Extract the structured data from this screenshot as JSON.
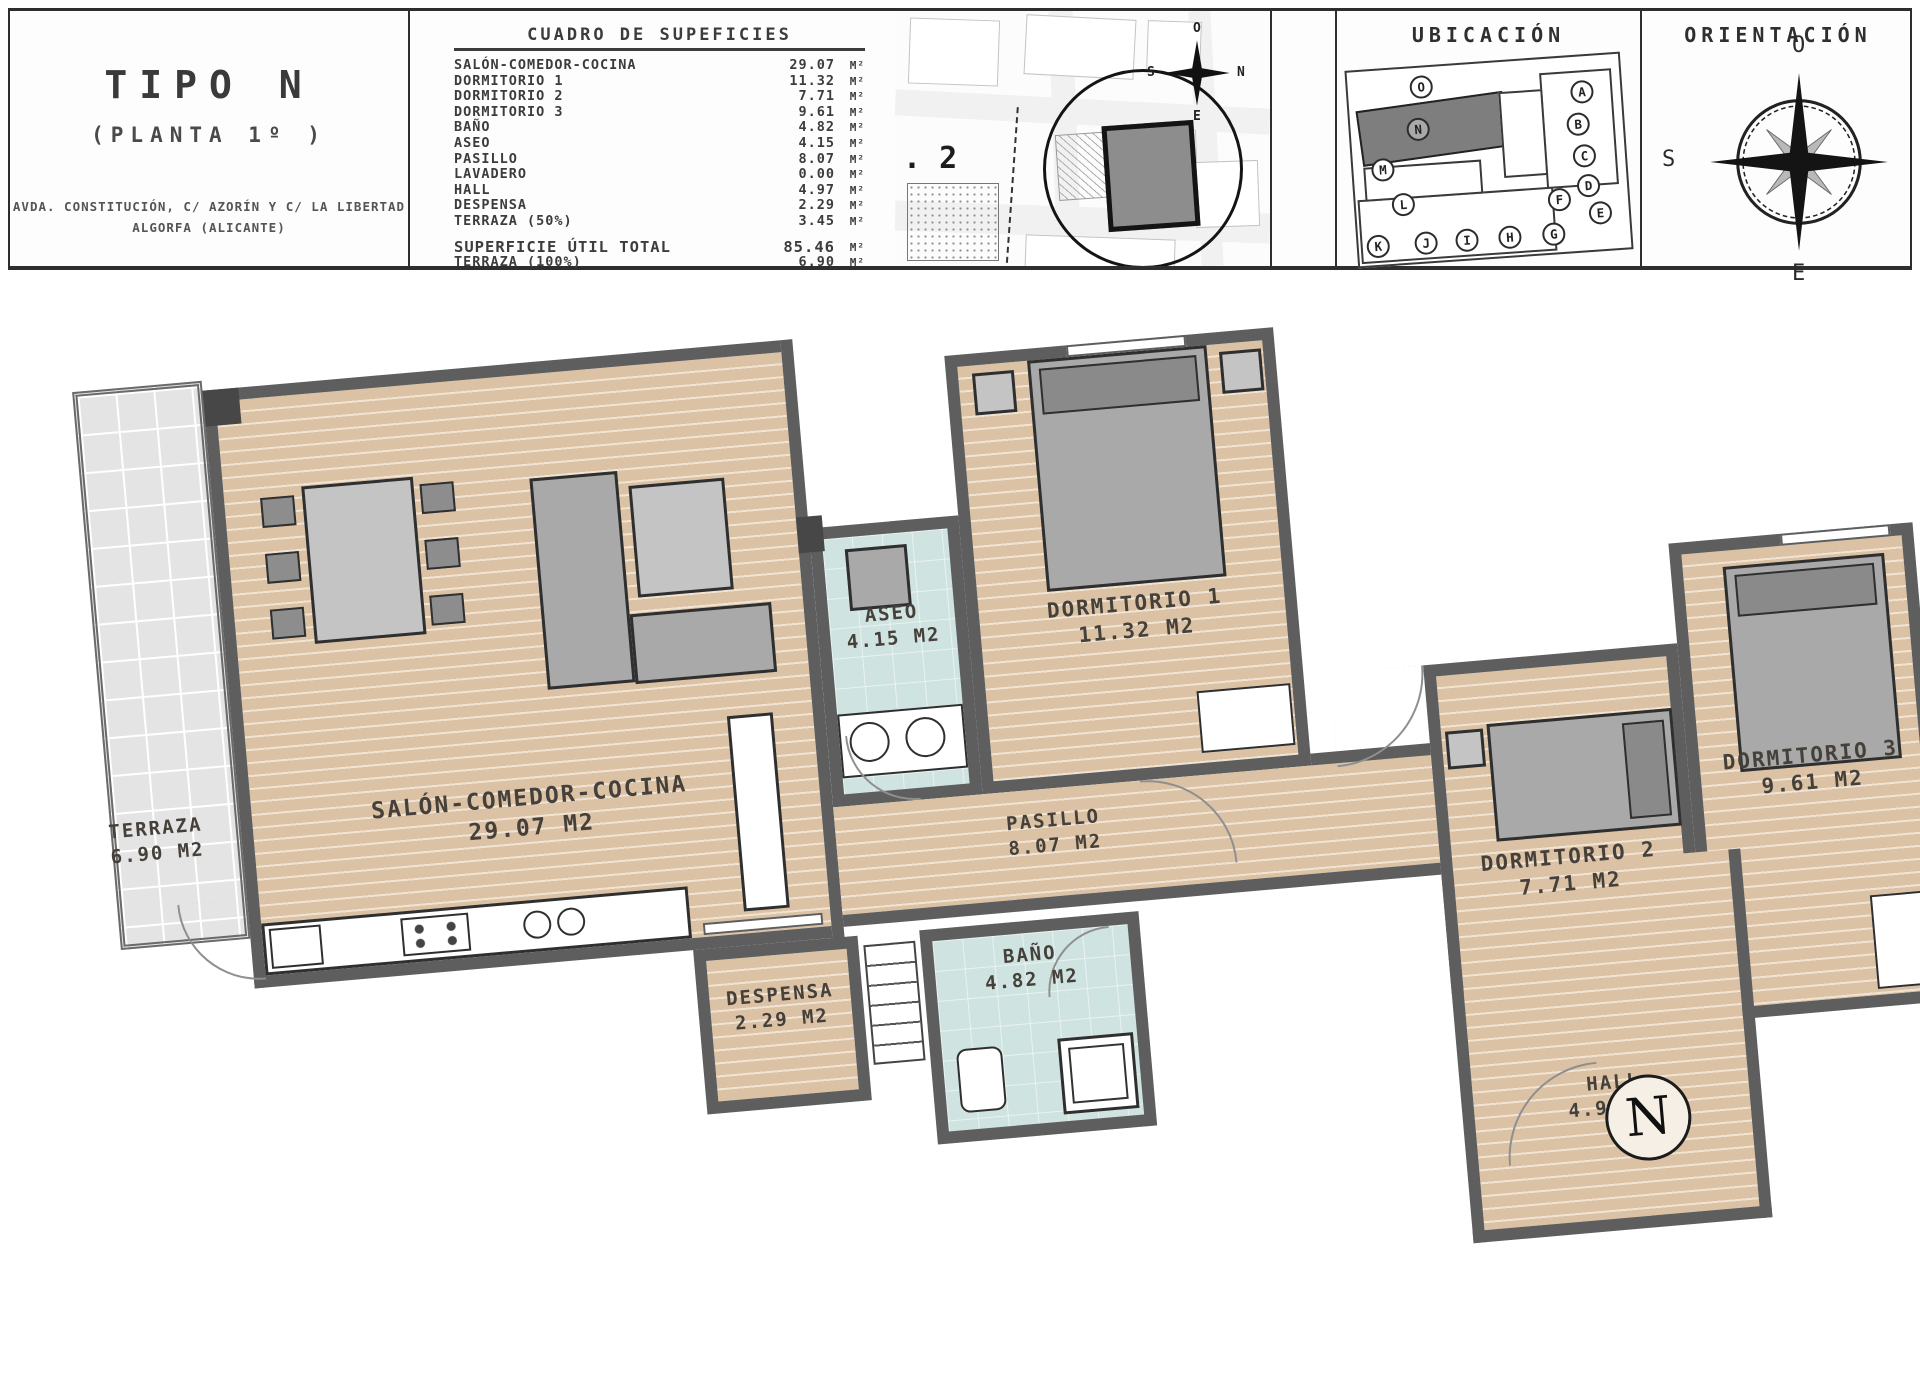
{
  "header": {
    "tipo": {
      "title": "TIPO N",
      "subtitle": "(PLANTA 1º )",
      "address1": "AVDA. CONSTITUCIÓN, C/ AZORÍN Y C/ LA LIBERTAD",
      "address2": "ALGORFA (ALICANTE)"
    },
    "cuadro": {
      "title": "CUADRO DE SUPEFICIES",
      "unit": "M²",
      "rows": [
        {
          "label": "SALÓN-COMEDOR-COCINA",
          "value": "29.07"
        },
        {
          "label": "DORMITORIO 1",
          "value": "11.32"
        },
        {
          "label": "DORMITORIO 2",
          "value": "7.71"
        },
        {
          "label": "DORMITORIO 3",
          "value": "9.61"
        },
        {
          "label": "BAÑO",
          "value": "4.82"
        },
        {
          "label": "ASEO",
          "value": "4.15"
        },
        {
          "label": "PASILLO",
          "value": "8.07"
        },
        {
          "label": "LAVADERO",
          "value": "0.00"
        },
        {
          "label": "HALL",
          "value": "4.97"
        },
        {
          "label": "DESPENSA",
          "value": "2.29"
        },
        {
          "label": "TERRAZA (50%)",
          "value": "3.45"
        }
      ],
      "totals": [
        {
          "label": "SUPERFICIE ÚTIL TOTAL",
          "value": "85.46"
        },
        {
          "label": "TERRAZA (100%)",
          "value": "6.90"
        }
      ]
    },
    "site_plan": {
      "plot_label": ". 2",
      "compass": {
        "top": "O",
        "left": "S",
        "right": "N",
        "bottom": "E"
      }
    },
    "ubicacion": {
      "title": "UBICACIÓN",
      "units": [
        "O",
        "N",
        "M",
        "L",
        "K",
        "J",
        "I",
        "H",
        "G",
        "F",
        "E",
        "A",
        "B",
        "C",
        "D"
      ],
      "highlighted_unit": "N"
    },
    "orientacion": {
      "title": "ORIENTACIÓN",
      "compass": {
        "top": "O",
        "left": "S",
        "right": "N",
        "bottom": "E"
      }
    }
  },
  "plan": {
    "rooms": [
      {
        "id": "terraza",
        "name": "TERRAZA",
        "area": "6.90 M2"
      },
      {
        "id": "salon",
        "name": "SALÓN-COMEDOR-COCINA",
        "area": "29.07 M2"
      },
      {
        "id": "aseo",
        "name": "ASEO",
        "area": "4.15 M2"
      },
      {
        "id": "dorm1",
        "name": "DORMITORIO 1",
        "area": "11.32 M2"
      },
      {
        "id": "pasillo",
        "name": "PASILLO",
        "area": "8.07 M2"
      },
      {
        "id": "dorm2",
        "name": "DORMITORIO 2",
        "area": "7.71 M2"
      },
      {
        "id": "dorm3",
        "name": "DORMITORIO 3",
        "area": "9.61 M2"
      },
      {
        "id": "despensa",
        "name": "DESPENSA",
        "area": "2.29 M2"
      },
      {
        "id": "bano",
        "name": "BAÑO",
        "area": "4.82 M2"
      },
      {
        "id": "hall",
        "name": "HALL",
        "area": "4.97 M2"
      }
    ],
    "north_marker": "N"
  },
  "colors": {
    "wall": "#5e5e5e",
    "floor_wood": "#dcc2a5",
    "floor_tile": "#e4e4e4",
    "floor_bath": "#cfe3e1",
    "line": "#2e2e2e"
  }
}
